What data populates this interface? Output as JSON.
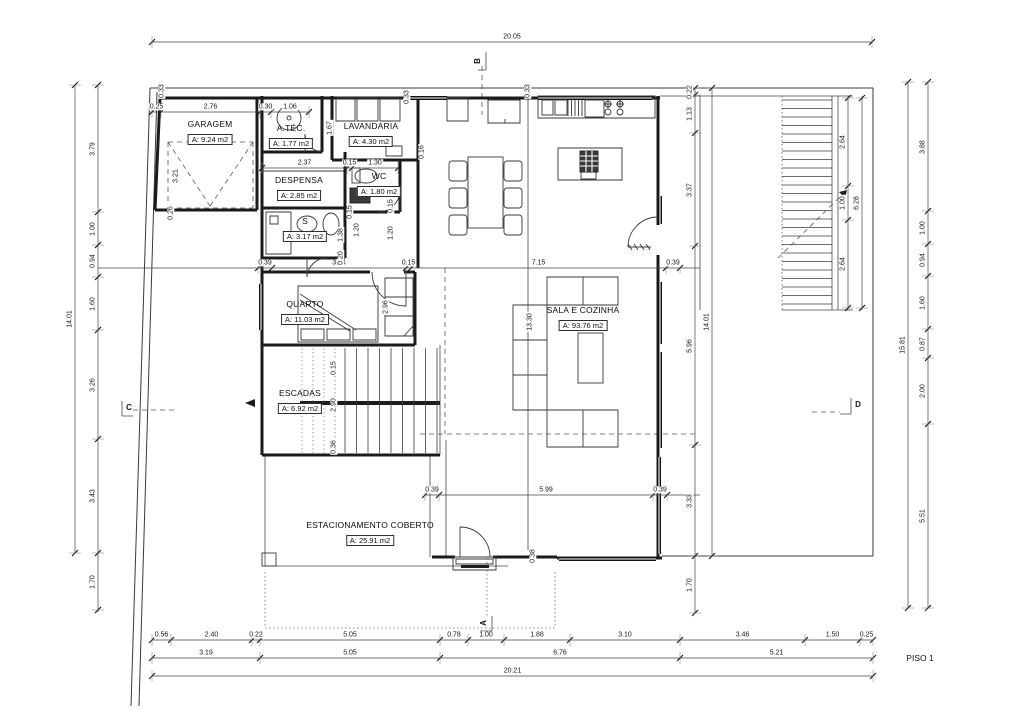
{
  "sheet": {
    "title": "PISO 1"
  },
  "rooms": [
    {
      "name": "GARAGEM",
      "area": "A: 9.24 m2",
      "x": 210,
      "y": 133
    },
    {
      "name": "A.TÉC.",
      "area": "A: 1.77 m2",
      "x": 291,
      "y": 137
    },
    {
      "name": "LAVANDARIA",
      "area": "A: 4.30 m2",
      "x": 371,
      "y": 135
    },
    {
      "name": "DESPENSA",
      "area": "A: 2.85 m2",
      "x": 299,
      "y": 189
    },
    {
      "name": "WC",
      "area": "A: 1.80 m2",
      "x": 379,
      "y": 185
    },
    {
      "name": "S",
      "area": "A: 3.17 m2",
      "x": 305,
      "y": 230
    },
    {
      "name": "QUARTO",
      "area": "A: 11.03 m2",
      "x": 305,
      "y": 313
    },
    {
      "name": "ESCADAS",
      "area": "A: 6.92 m2",
      "x": 300,
      "y": 402
    },
    {
      "name": "SALA E COZINHA",
      "area": "A: 93.76 m2",
      "x": 583,
      "y": 319
    },
    {
      "name": "ESTACIONAMENTO COBERTO",
      "area": "A: 25.91 m2",
      "x": 370,
      "y": 534
    }
  ],
  "section_markers": [
    {
      "label": "B",
      "x": 478,
      "y": 61,
      "rot": true
    },
    {
      "label": "A",
      "x": 484,
      "y": 623,
      "rot": true
    },
    {
      "label": "C",
      "x": 129,
      "y": 408,
      "rot": false
    },
    {
      "label": "D",
      "x": 858,
      "y": 405,
      "rot": false
    }
  ],
  "dim_lines": [
    {
      "orient": "h",
      "pos": 42,
      "from": 152,
      "to": 872,
      "ticks": [
        152,
        872
      ],
      "labels": [
        "20.05"
      ]
    },
    {
      "orient": "h",
      "pos": 112,
      "from": 150,
      "to": 310,
      "ticks": [
        152,
        161,
        260,
        271,
        309
      ],
      "labels": [
        "0.25",
        "2.76",
        "0.30",
        "1.06"
      ]
    },
    {
      "orient": "h",
      "pos": 168,
      "from": 262,
      "to": 398,
      "ticks": [
        262,
        347,
        352,
        398
      ],
      "labels": [
        "2.37",
        "0.15",
        "1.30"
      ]
    },
    {
      "orient": "h",
      "pos": 268,
      "from": 98,
      "to": 700,
      "ticks": [
        258,
        272,
        406,
        411,
        666,
        680
      ],
      "labels": [
        "0.39",
        "3.74",
        "0.15",
        "7.15",
        "0.39"
      ]
    },
    {
      "orient": "h",
      "pos": 495,
      "from": 425,
      "to": 700,
      "ticks": [
        425,
        439,
        653,
        667
      ],
      "labels": [
        "0.39",
        "5.99",
        "0.39"
      ]
    },
    {
      "orient": "h",
      "pos": 640,
      "from": 152,
      "to": 873,
      "ticks": [
        152,
        171,
        252,
        260,
        440,
        468,
        504,
        570,
        680,
        805,
        860,
        873
      ],
      "labels": [
        "0.56",
        "2.40",
        "0.22",
        "5.05",
        "0.78",
        "1.00",
        "1.88",
        "3.10",
        "3.46",
        "1.50",
        "0.25"
      ]
    },
    {
      "orient": "h",
      "pos": 658,
      "from": 152,
      "to": 873,
      "ticks": [
        152,
        260,
        440,
        680,
        873
      ],
      "labels": [
        "3.19",
        "5.05",
        "6.76",
        "5.21"
      ]
    },
    {
      "orient": "h",
      "pos": 676,
      "from": 152,
      "to": 873,
      "ticks": [
        152,
        873
      ],
      "labels": [
        "20.21"
      ]
    },
    {
      "orient": "v",
      "pos": 75,
      "from": 85,
      "to": 553,
      "ticks": [
        85,
        553
      ],
      "labels": [
        "14.01"
      ]
    },
    {
      "orient": "v",
      "pos": 98,
      "from": 85,
      "to": 612,
      "ticks": [
        85,
        212,
        245,
        277,
        330,
        439,
        553,
        610
      ],
      "labels": [
        "3.79",
        "1.00",
        "0.94",
        "1.60",
        "3.26",
        "3.43",
        "1.70"
      ]
    },
    {
      "orient": "v",
      "pos": 848,
      "from": 96,
      "to": 310,
      "ticks": [
        98,
        186,
        220,
        308
      ],
      "labels": [
        "2.64",
        "1.00",
        "2.64"
      ]
    },
    {
      "orient": "v",
      "pos": 862,
      "from": 96,
      "to": 310,
      "ticks": [
        98,
        308
      ],
      "labels": [
        "6.28"
      ]
    },
    {
      "orient": "v",
      "pos": 908,
      "from": 82,
      "to": 608,
      "ticks": [
        82,
        608
      ],
      "labels": [
        "15.81"
      ]
    },
    {
      "orient": "v",
      "pos": 928,
      "from": 82,
      "to": 608,
      "ticks": [
        82,
        211,
        244,
        276,
        329,
        358,
        424,
        608
      ],
      "labels": [
        "3.88",
        "1.00",
        "0.94",
        "1.60",
        "0.87",
        "2.00",
        "5.51"
      ]
    },
    {
      "orient": "v",
      "pos": 695,
      "from": 88,
      "to": 613,
      "ticks": [
        88,
        95,
        133,
        246,
        445,
        556,
        613
      ],
      "labels": [
        "0.22",
        "1.13",
        "3.37",
        "5.96",
        "3.33",
        "1.70"
      ]
    },
    {
      "orient": "v",
      "pos": 712,
      "from": 88,
      "to": 556,
      "ticks": [
        88,
        556
      ],
      "labels": [
        "14.01"
      ]
    }
  ],
  "free_dims": [
    {
      "t": "0.33",
      "x": 162,
      "y": 91
    },
    {
      "t": "3.21",
      "x": 176,
      "y": 176
    },
    {
      "t": "0.26",
      "x": 171,
      "y": 213
    },
    {
      "t": "1.67",
      "x": 330,
      "y": 128
    },
    {
      "t": "0.33",
      "x": 407,
      "y": 97
    },
    {
      "t": "0.16",
      "x": 422,
      "y": 152
    },
    {
      "t": "0.15",
      "x": 350,
      "y": 212
    },
    {
      "t": "1.20",
      "x": 357,
      "y": 230
    },
    {
      "t": "1.38",
      "x": 341,
      "y": 235
    },
    {
      "t": "0.20",
      "x": 341,
      "y": 258
    },
    {
      "t": "0.15",
      "x": 391,
      "y": 206
    },
    {
      "t": "1.20",
      "x": 391,
      "y": 233
    },
    {
      "t": "2.96",
      "x": 386,
      "y": 307
    },
    {
      "t": "0.15",
      "x": 334,
      "y": 368
    },
    {
      "t": "2.90",
      "x": 334,
      "y": 405
    },
    {
      "t": "0.36",
      "x": 334,
      "y": 447
    },
    {
      "t": "13.30",
      "x": 530,
      "y": 322
    },
    {
      "t": "0.33",
      "x": 528,
      "y": 91
    },
    {
      "t": "0.38",
      "x": 533,
      "y": 556
    }
  ]
}
